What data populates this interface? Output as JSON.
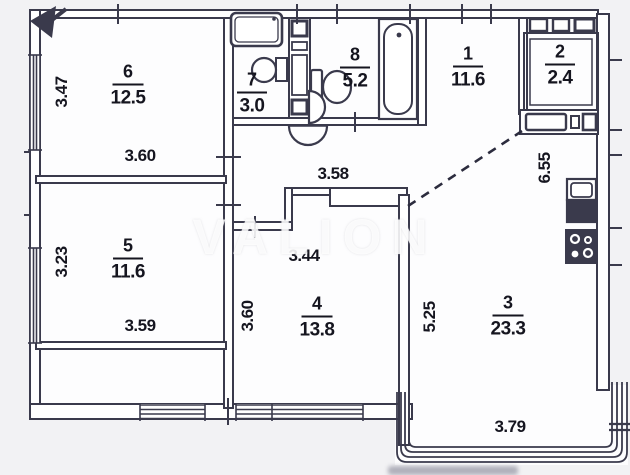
{
  "watermark": "VALION",
  "colors": {
    "line": "#3a3a4c",
    "text": "#15151f",
    "background": "#f2f2f4",
    "watermark": "#ffffff"
  },
  "rooms": [
    {
      "number": "1",
      "area": "11.6"
    },
    {
      "number": "2",
      "area": "2.4"
    },
    {
      "number": "3",
      "area": "23.3"
    },
    {
      "number": "4",
      "area": "13.8"
    },
    {
      "number": "5",
      "area": "11.6"
    },
    {
      "number": "6",
      "area": "12.5"
    },
    {
      "number": "7",
      "area": "3.0"
    },
    {
      "number": "8",
      "area": "5.2"
    }
  ],
  "dims": {
    "d347": "3.47",
    "d360a": "3.60",
    "d358": "3.58",
    "d323": "3.23",
    "d359": "3.59",
    "d344": "3.44",
    "d360b": "3.60",
    "d525": "5.25",
    "d655": "6.55",
    "d379": "3.79"
  },
  "fixtures": [
    "bathtub-icon",
    "toilet-icon",
    "washbasin-icon",
    "pedestal-sink-icon",
    "washing-machine-icon",
    "kitchen-sink-icon",
    "stove-icon",
    "entry-arrow-icon",
    "balcony-glazing",
    "vent-shaft",
    "door-swing-arc"
  ]
}
